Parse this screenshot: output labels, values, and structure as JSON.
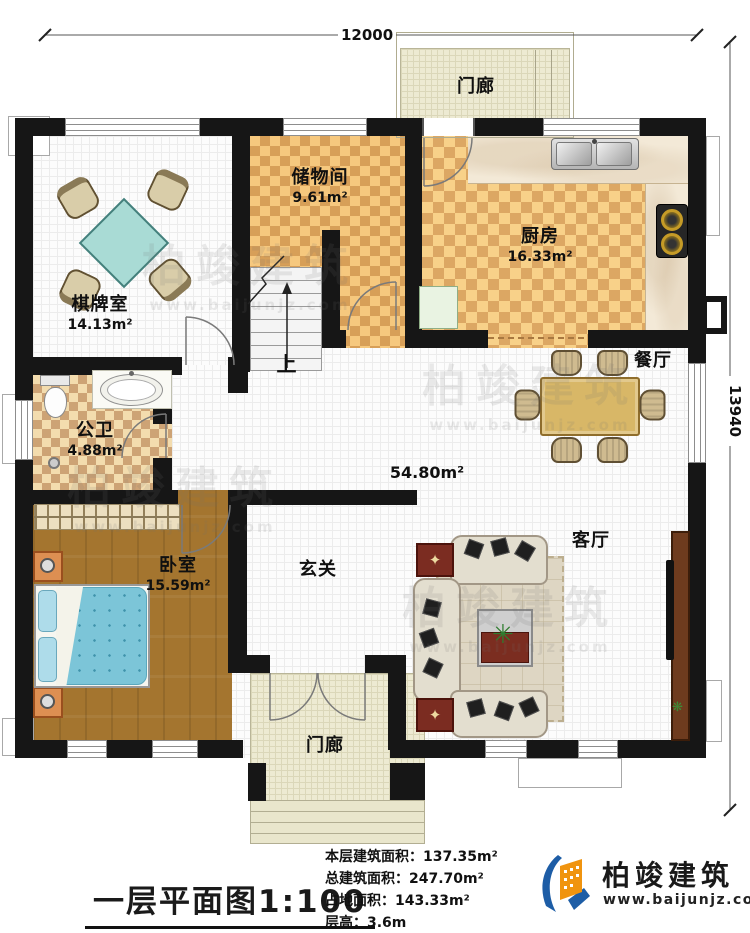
{
  "plan": {
    "title": "一层平面图1:100",
    "dimensions": {
      "width": "12000",
      "height": "13940"
    },
    "stats": [
      {
        "label": "本层建筑面积：",
        "value": "137.35m²"
      },
      {
        "label": "总建筑面积：",
        "value": "247.70m²"
      },
      {
        "label": "占地面积：",
        "value": "143.33m²"
      },
      {
        "label": "层高：",
        "value": "3.6m"
      }
    ],
    "rooms": {
      "porch_top": {
        "name": "门廊"
      },
      "storage": {
        "name": "储物间",
        "area": "9.61m²"
      },
      "kitchen": {
        "name": "厨房",
        "area": "16.33m²"
      },
      "chess": {
        "name": "棋牌室",
        "area": "14.13m²"
      },
      "bath": {
        "name": "公卫",
        "area": "4.88m²"
      },
      "dining": {
        "name": "餐厅"
      },
      "hall": {
        "area": "54.80m²"
      },
      "foyer": {
        "name": "玄关"
      },
      "living": {
        "name": "客厅"
      },
      "bedroom": {
        "name": "卧室",
        "area": "15.59m²"
      },
      "porch_bottom": {
        "name": "门廊"
      },
      "stairs": {
        "up": "上"
      }
    },
    "branding": {
      "company": "柏竣建筑",
      "website": "www.baijunjz.com"
    },
    "watermark": {
      "line1": "柏竣建筑",
      "line2": "www.baijunjz.com"
    }
  }
}
